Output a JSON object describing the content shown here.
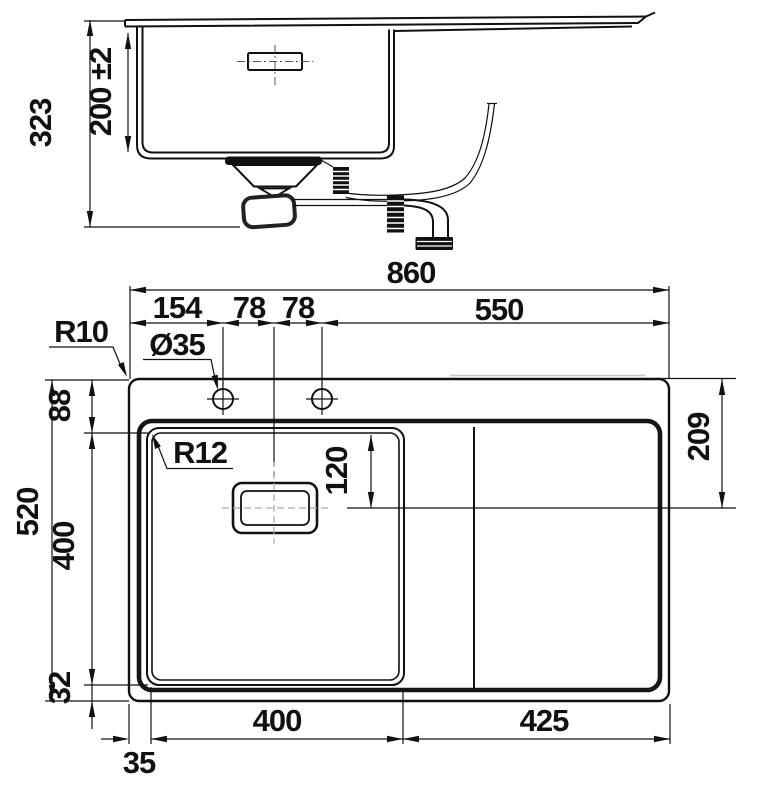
{
  "drawing": {
    "type": "sink-installation-technical-drawing",
    "colors": {
      "line": "#111111",
      "background": "#ffffff",
      "faint": "#c4c4c4"
    },
    "side_view": {
      "dims": {
        "overall_height": "323",
        "bowl_depth": "200 ±2"
      }
    },
    "plan_view": {
      "dims": {
        "overall_width": "860",
        "tap_hole_offset": "154",
        "tap_spacing_left": "78",
        "tap_spacing_right": "78",
        "right_section_width": "550",
        "overall_depth": "520",
        "rim_to_bowl_top": "88",
        "bowl_front_to_back": "400",
        "bowl_to_rim_bottom": "32",
        "drain_center_from_top": "209",
        "drain_center_from_bowl_top": "120",
        "bowl_width": "400",
        "drainboard_width": "425",
        "left_margin": "35"
      },
      "labels": {
        "outer_corner_radius": "R10",
        "tap_hole_diameter": "Ø35",
        "bowl_corner_radius": "R12"
      }
    }
  }
}
